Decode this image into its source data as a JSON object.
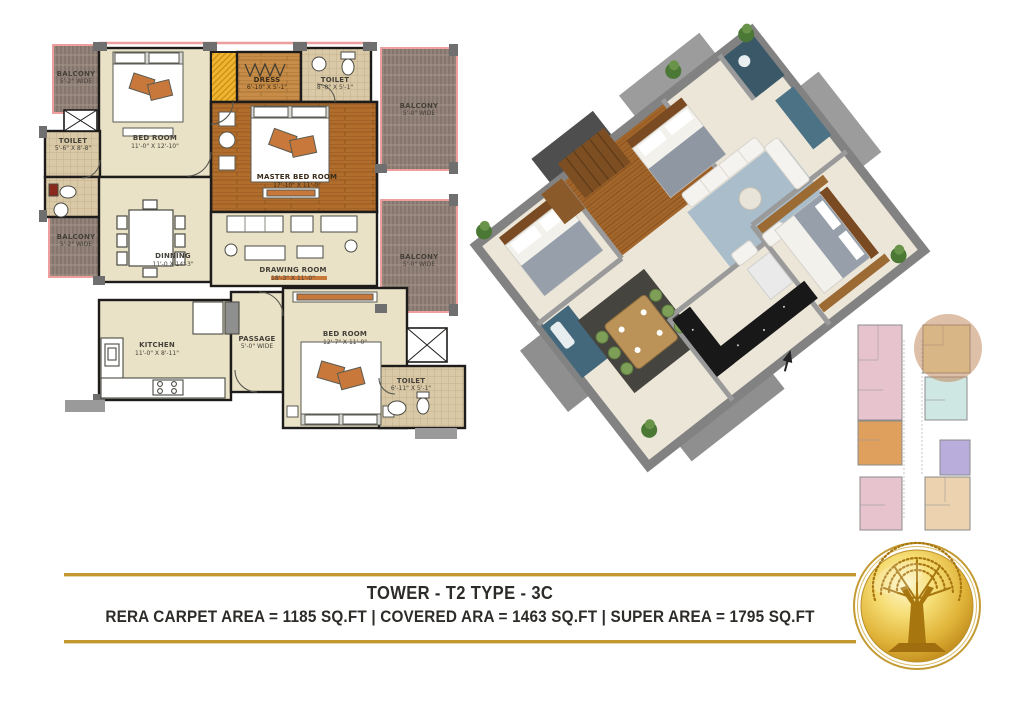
{
  "title_block": {
    "title": "TOWER - T2 TYPE - 3C",
    "areas_line": "RERA CARPET AREA = 1185 SQ.FT   |   COVERED ARA = 1463 SQ.FT   |   SUPER AREA = 1795 SQ.FT",
    "accent_gold": "#c3992f",
    "text_color": "#2e2c29"
  },
  "floorplan_2d": {
    "rooms": [
      {
        "id": "balcony-top-left",
        "name": "BALCONY",
        "dims": "5'-2\" WIDE"
      },
      {
        "id": "toilet-left",
        "name": "TOILET",
        "dims": "5'-6\" X 8'-8\""
      },
      {
        "id": "balcony-bottom-left",
        "name": "BALCONY",
        "dims": "5'-2\" WIDE"
      },
      {
        "id": "bedroom-1",
        "name": "BED ROOM",
        "dims": "11'-0\" X 12'-10\""
      },
      {
        "id": "dress",
        "name": "DRESS",
        "dims": "6'-10\" X 5'-1\""
      },
      {
        "id": "toilet-top",
        "name": "TOILET",
        "dims": "8'-8\" X 5'-1\""
      },
      {
        "id": "master-bedroom",
        "name": "MASTER BED ROOM",
        "dims": "17'-10\" X 11'-0\""
      },
      {
        "id": "balcony-right-top",
        "name": "BALCONY",
        "dims": "5'-0\" WIDE"
      },
      {
        "id": "dinning",
        "name": "DINNING",
        "dims": "11'-0 X 14'-3\""
      },
      {
        "id": "drawing-room",
        "name": "DRAWING ROOM",
        "dims": "18'-3\" X 11'-0\""
      },
      {
        "id": "balcony-right-bottom",
        "name": "BALCONY",
        "dims": "5'-0\" WIDE"
      },
      {
        "id": "kitchen",
        "name": "KITCHEN",
        "dims": "11'-0\" X 8'-11\""
      },
      {
        "id": "passage",
        "name": "PASSAGE",
        "dims": "5'-0\" WIDE"
      },
      {
        "id": "bedroom-2",
        "name": "BED ROOM",
        "dims": "12'-7\" X 11'-0\""
      },
      {
        "id": "toilet-bottom-right",
        "name": "TOILET",
        "dims": "6'-11\" X 5'-1\""
      }
    ]
  },
  "key_plan": {
    "highlight_color": "rgba(195,138,94,0.55)",
    "units": [
      {
        "id": "unit-top-left",
        "color": "#e7c3ce"
      },
      {
        "id": "unit-mid-left",
        "color": "#dfa05e"
      },
      {
        "id": "unit-bottom-left",
        "color": "#e7c3ce"
      },
      {
        "id": "unit-highlighted",
        "color": "#f1ecb4"
      },
      {
        "id": "unit-mid-right",
        "color": "#cfe7e2"
      },
      {
        "id": "unit-right",
        "color": "#b9addc"
      },
      {
        "id": "unit-bottom-right",
        "color": "#ecd2ae"
      }
    ]
  },
  "icons": {
    "logo": "golden-tree-coin-logo",
    "north_arrow": "north-arrow"
  }
}
